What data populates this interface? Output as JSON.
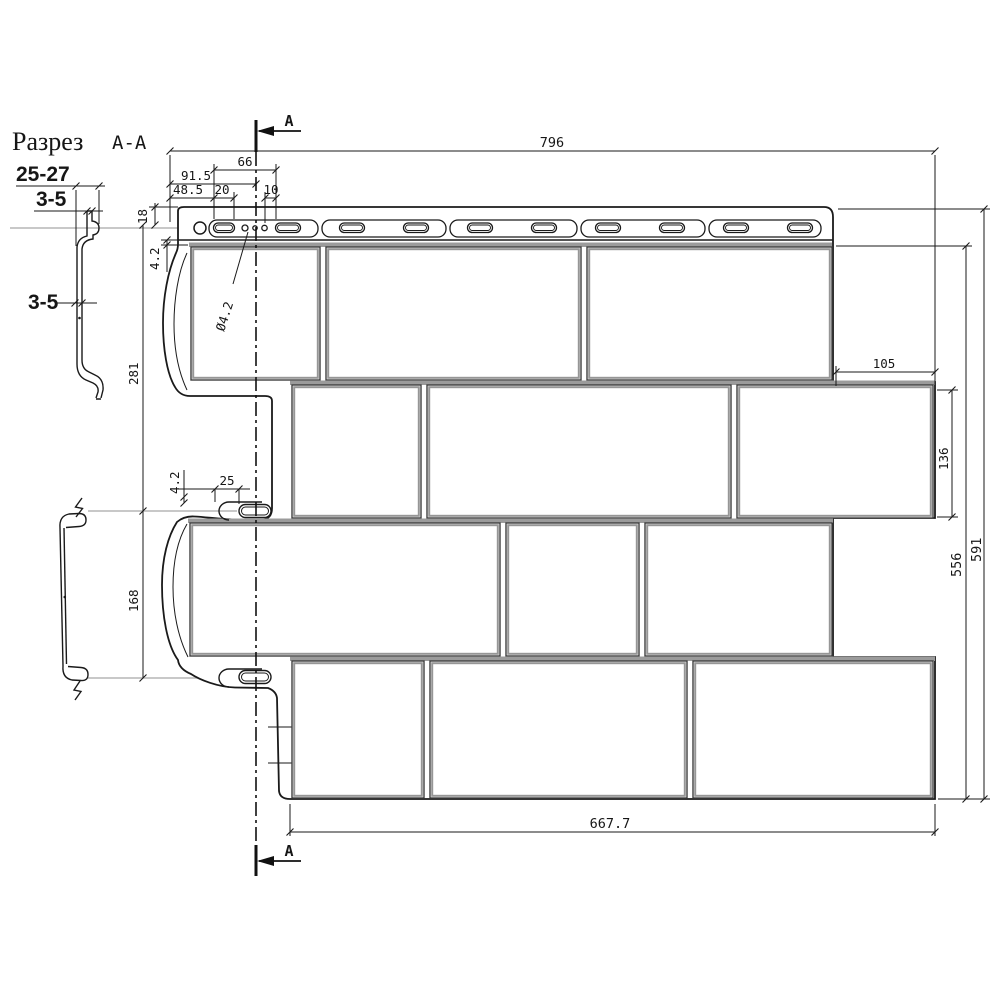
{
  "section_view": {
    "title": "Разрез",
    "ref": "А-А",
    "width_range": "25-27",
    "thickness_top": "3-5",
    "thickness_body": "3-5"
  },
  "section_cut": {
    "label": "A"
  },
  "dims": {
    "total_width": "796",
    "total_height": "591",
    "field_height": "556",
    "bottom_width": "667.7",
    "slot_offset": "91.5",
    "slot_group": "66",
    "slot_start": "48.5",
    "slot_len_top": "20",
    "hole_gap": "10",
    "top_edge": "18",
    "lap_top": "4.2",
    "hole_dia": "Ø4.2",
    "row_pitch_upper": "281",
    "row_pitch_lower": "168",
    "lap_mid": "4.2",
    "slot_len_mid": "25",
    "right_overhang": "105",
    "brick_height": "136"
  },
  "drawing": {
    "colors": {
      "line": "#1a1a1a",
      "brick": "#3f3f3f",
      "groove": "#969696",
      "band": "#9b9b9b",
      "projection": "#b5b5b5"
    },
    "brick_rows": [
      {
        "y": 247,
        "h": 133,
        "band_x": [
          189,
          832
        ],
        "bricks": [
          [
            191,
            320
          ],
          [
            326,
            581
          ],
          [
            587,
            832
          ]
        ]
      },
      {
        "y": 385,
        "h": 133,
        "band_x": [
          290,
          935
        ],
        "bricks": [
          [
            292,
            421
          ],
          [
            427,
            731
          ],
          [
            737,
            933
          ]
        ]
      },
      {
        "y": 523,
        "h": 133,
        "band_x": [
          188,
          833
        ],
        "bricks": [
          [
            190,
            500
          ],
          [
            506,
            639
          ],
          [
            645,
            832
          ]
        ]
      },
      {
        "y": 661,
        "h": 137,
        "band_x": [
          290,
          935
        ],
        "bricks": [
          [
            292,
            424
          ],
          [
            430,
            687
          ],
          [
            693,
            933
          ]
        ]
      }
    ],
    "hem_boxes": [
      [
        209,
        318
      ],
      [
        322,
        446
      ],
      [
        450,
        577
      ],
      [
        581,
        705
      ],
      [
        709,
        821
      ]
    ],
    "slots": {
      "y": 223,
      "h": 9.5,
      "first_len": 21,
      "len": 25,
      "centers": [
        224,
        288,
        352,
        416,
        480,
        544,
        608,
        672,
        736,
        800
      ]
    }
  }
}
